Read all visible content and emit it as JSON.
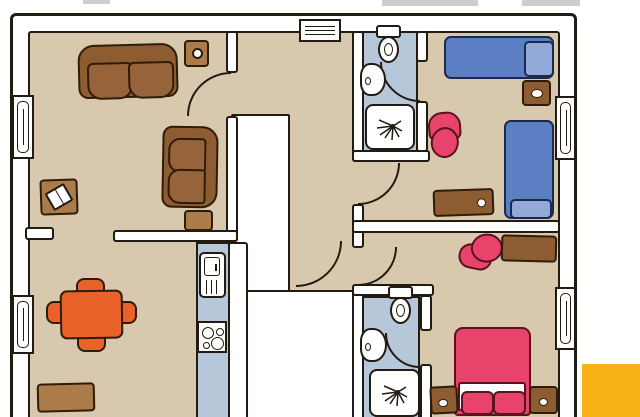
{
  "palette": {
    "paper": "#ffffff",
    "ink": "#211b12",
    "inkwarm": "#2e1c09",
    "floor": "#d8c9ae",
    "wall": "#ffffff",
    "wet": "#b7c7da",
    "wood": "#8e5c31",
    "woodmid": "#96633a",
    "woodlite": "#ab7b49",
    "bedblue": "#5c7ec2",
    "bedink": "#1b2a4c",
    "pillow": "#93aad8",
    "orange": "#e8622a",
    "pink": "#e8436a",
    "pinkink": "#5c1022",
    "yellow": "#f8b117",
    "gray": "#cdcdcd"
  },
  "scene": {
    "type": "hand-drawn apartment floor plan, top view, no text labels",
    "rooms": [
      "living-room",
      "dining-room",
      "kitchen",
      "entry-hall",
      "corridor",
      "bathroom-top",
      "bathroom-bottom",
      "bedroom-top-right",
      "bedroom-bottom-right"
    ],
    "furniture": {
      "living_room": [
        "sofa",
        "armchair",
        "lamp-side-table",
        "reading-table-with-open-book",
        "side-table"
      ],
      "dining_room": [
        "orange-dining-table",
        "dining-chair-top",
        "dining-chair-bottom",
        "dining-chair-left",
        "dining-chair-right",
        "sideboard"
      ],
      "kitchen": [
        "refrigerator",
        "stove-4-burners"
      ],
      "bathroom_top": [
        "toilet",
        "sink",
        "shower"
      ],
      "bathroom_bottom": [
        "toilet",
        "sink",
        "shower"
      ],
      "bedroom_top_right": [
        "single-bed-horizontal",
        "single-bed-vertical",
        "nightstand",
        "pink-armchair",
        "desk-with-knob"
      ],
      "bedroom_bottom_right": [
        "double-bed-pink",
        "nightstand-left",
        "nightstand-right",
        "pink-armchair",
        "desk"
      ]
    },
    "openings": [
      "front-door-top",
      "window-left-upper",
      "window-left-lower",
      "window-right-upper",
      "window-right-lower",
      "door-arc-living",
      "door-arc-bedroom-top",
      "door-arc-bedroom-bottom",
      "door-arc-corridor",
      "door-arc-bathroom-top",
      "door-arc-bathroom-bottom"
    ],
    "misc": [
      "stair-void-upper",
      "stair-void-lower",
      "yellow-corner-swatch",
      "gray-cutoff-fragments-top"
    ]
  }
}
